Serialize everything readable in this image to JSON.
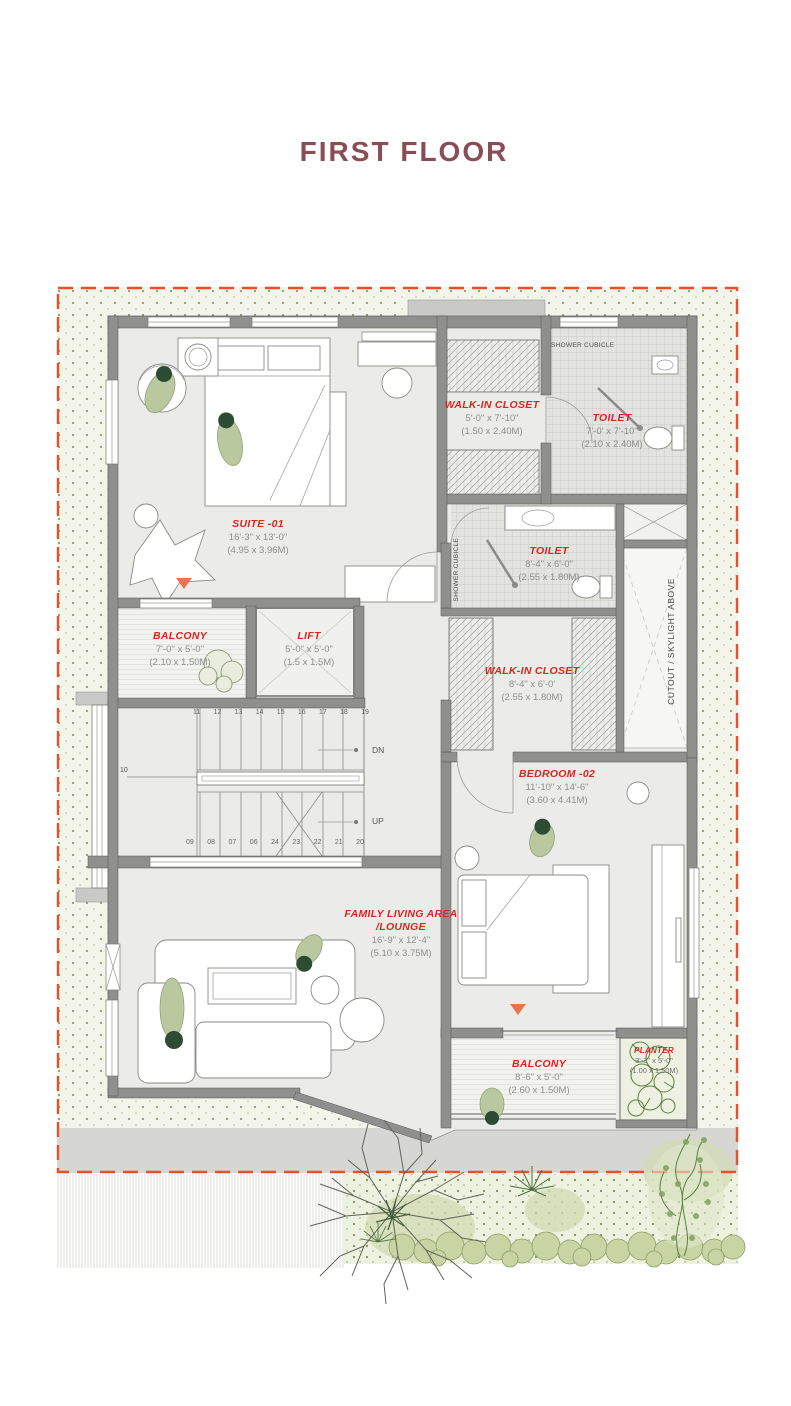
{
  "title": "FIRST FLOOR",
  "colors": {
    "title": "#8a4d55",
    "room_label": "#d9261f",
    "boundary": "#e8502a",
    "marker": "#e87450",
    "person": "#bac89f"
  },
  "rooms": {
    "suite01": {
      "name": "SUITE -01",
      "dim_ft": "16'-3\" x 13'-0\"",
      "dim_m": "(4.95 x 3.96M)"
    },
    "walkin_top": {
      "name": "WALK-IN CLOSET",
      "dim_ft": "5'-0\" x 7'-10\"",
      "dim_m": "(1.50 x 2.40M)"
    },
    "toilet_top": {
      "name": "TOILET",
      "dim_ft": "7'-0' x 7'-10\"",
      "dim_m": "(2.10 x 2.40M)"
    },
    "balcony_upper": {
      "name": "BALCONY",
      "dim_ft": "7'-0'' x 5'-0''",
      "dim_m": "(2.10 x 1.50M)"
    },
    "lift": {
      "name": "LIFT",
      "dim_ft": "5'-0\" x 5'-0\"",
      "dim_m": "(1.5 x 1.5M)"
    },
    "toilet_mid": {
      "name": "TOILET",
      "dim_ft": "8'-4\" x 6'-0\"",
      "dim_m": "(2.55 x 1.80M)"
    },
    "walkin_mid": {
      "name": "WALK-IN CLOSET",
      "dim_ft": "8'-4\" x 6'-0'",
      "dim_m": "(2.55 x 1.80M)"
    },
    "bedroom02": {
      "name": "BEDROOM -02",
      "dim_ft": "11'-10\" x 14'-6\"",
      "dim_m": "(3.60 x 4.41M)"
    },
    "family": {
      "name": "FAMILY LIVING AREA",
      "name2": "/LOUNGE",
      "dim_ft": "16'-9\" x 12'-4\"",
      "dim_m": "(5.10 x 3.75M)"
    },
    "balcony_lower": {
      "name": "BALCONY",
      "dim_ft": "8'-6\" x 5'-0\"",
      "dim_m": "(2.60 x 1.50M)"
    },
    "planter": {
      "name": "PLANTER",
      "dim_ft": "3'-3\" x 5'-0\"",
      "dim_m": "(1.00 x 1.50M)"
    }
  },
  "annotations": {
    "shower_top": "SHOWER CUBICLE",
    "shower_mid": "SHOWER CUBICLE",
    "cutout": "CUTOUT / SKYLIGHT ABOVE"
  },
  "stairs": {
    "dn": "DN",
    "up": "UP",
    "left": "10",
    "top": [
      "11",
      "12",
      "13",
      "14",
      "15",
      "16",
      "17",
      "18",
      "19"
    ],
    "bottom": [
      "09",
      "08",
      "07",
      "06",
      "24",
      "23",
      "22",
      "21",
      "20"
    ]
  }
}
